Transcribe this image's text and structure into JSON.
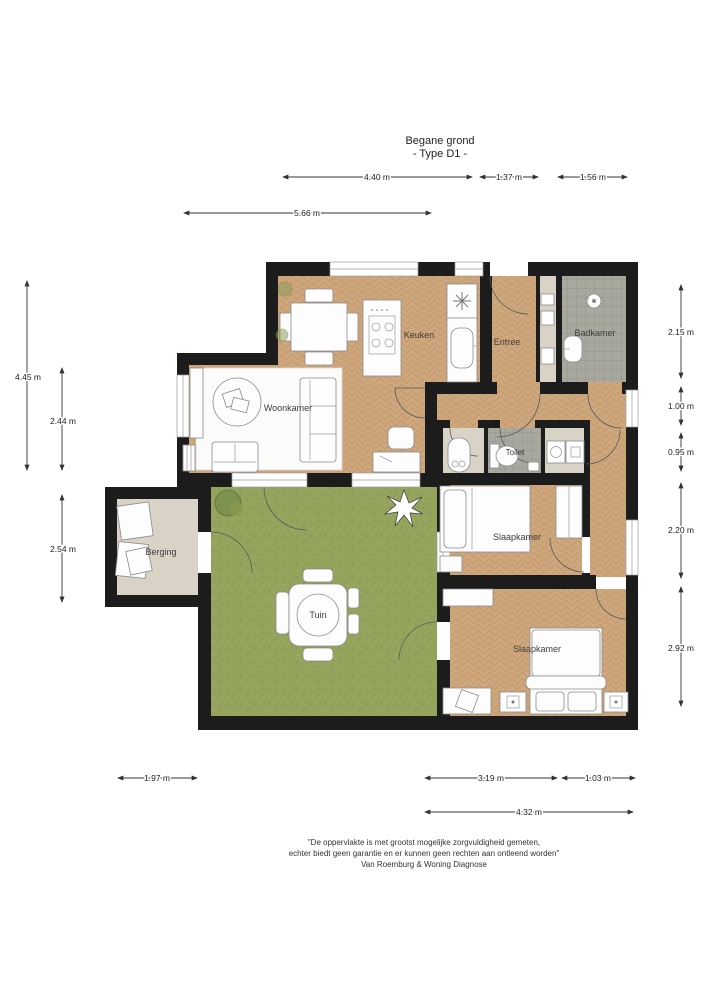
{
  "title": {
    "line1": "Begane grond",
    "line2": "- Type D1 -"
  },
  "rooms": {
    "keuken": "Keuken",
    "entree": "Entree",
    "badkamer": "Badkamer",
    "woonkamer": "Woonkamer",
    "toilet": "Toilet",
    "slaapkamer1": "Slaapkamer",
    "slaapkamer2": "Slaapkamer",
    "berging": "Berging",
    "tuin": "Tuin"
  },
  "dimensions": {
    "top": {
      "d1": "4.40 m",
      "d2": "1.37 m",
      "d3": "1.56 m",
      "d4": "5.66 m"
    },
    "left": {
      "d1": "4.45 m",
      "d2": "2.44 m",
      "d3": "2.54 m"
    },
    "right": {
      "d1": "2.15 m",
      "d2": "1.00 m",
      "d3": "0.95 m",
      "d4": "2.20 m",
      "d5": "2.92 m"
    },
    "bottom": {
      "d1": "1.97 m",
      "d2": "3.19 m",
      "d3": "1.03 m",
      "d4": "4.32 m"
    }
  },
  "footer": {
    "line1": "\"De oppervlakte is met grootst mogelijke zorgvuldigheid gemeten,",
    "line2": "echter biedt geen garantie en er kunnen geen rechten aan ontleend worden\"",
    "line3": "Van Roemburg & Woning Diagnose"
  },
  "colors": {
    "wall": "#1c1c1c",
    "wood_floor": "#cfa77c",
    "tile_floor": "#a8a89e",
    "grass": "#95a45d",
    "storage_floor": "#d8d3c6",
    "rug": "#fbfbf9"
  }
}
